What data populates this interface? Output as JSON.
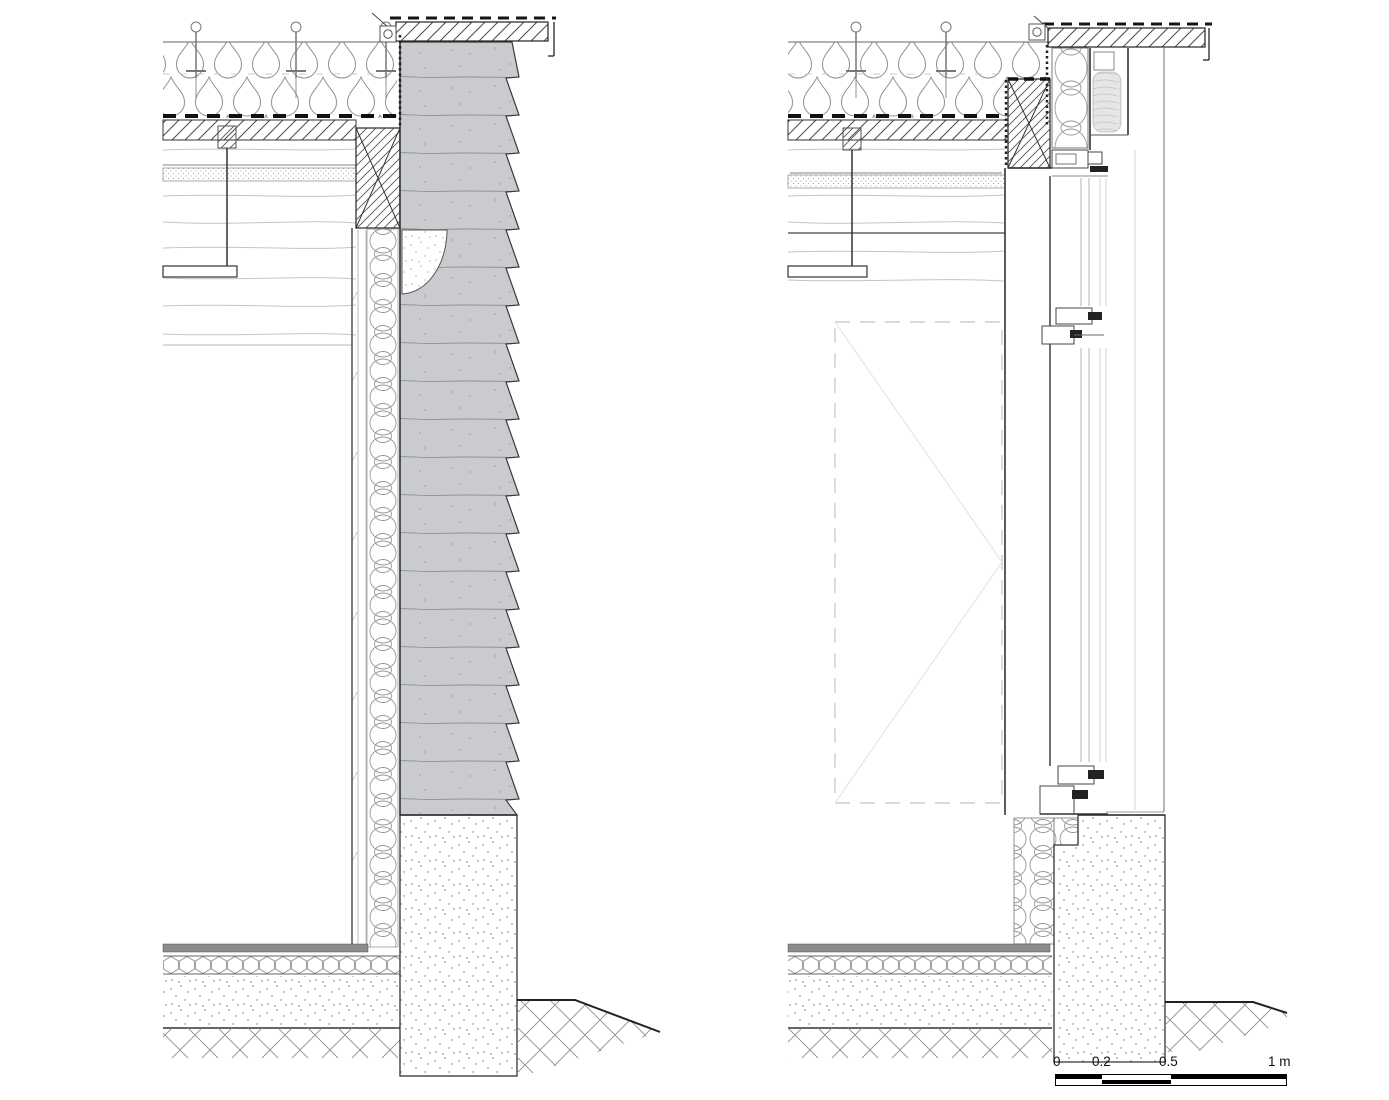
{
  "drawing": {
    "type": "architectural-section-details",
    "details": [
      {
        "id": "detail-left",
        "label": "Solid stone wall vertical section",
        "components": [
          "parapet-coping",
          "coping-membrane",
          "coping-anchor",
          "roof-insulation",
          "insulation-fasteners",
          "vapour-membrane",
          "roof-deck",
          "timber-beams",
          "service-board",
          "ceiling-hanger",
          "suspended-ceiling-board",
          "timber-blocking",
          "stone-masonry-wall",
          "corbel-infill",
          "interior-insulation",
          "interior-lining",
          "floor-finish",
          "floor-insulation-board",
          "floor-slab",
          "hardcore-ground",
          "concrete-plinth",
          "exterior-ground"
        ]
      },
      {
        "id": "detail-right",
        "label": "Glazed door / window vertical section",
        "components": [
          "parapet-coping",
          "coping-membrane",
          "coping-anchor",
          "roof-insulation",
          "insulation-fasteners",
          "vapour-membrane",
          "roof-deck",
          "timber-beams",
          "service-board",
          "ceiling-hanger",
          "suspended-ceiling-board",
          "timber-blocking",
          "head-insulation-box",
          "roller-blind-housing",
          "roller-blind-roll",
          "window-head-frame",
          "glazing",
          "transom-profile",
          "door-leaf-projection",
          "sill-frame",
          "sill-insulation",
          "floor-finish",
          "floor-insulation-board",
          "floor-slab",
          "hardcore-ground",
          "concrete-plinth",
          "exterior-ground"
        ]
      }
    ]
  },
  "scale_bar": {
    "labels": [
      "0",
      "0.2",
      "0.5",
      "1 m"
    ]
  },
  "colors": {
    "background": "#ffffff",
    "stone_fill": "#c9cbce",
    "blind_fill": "#e6e6e6",
    "floor_finish": "#8c8c8c",
    "ink": "#2f2f2f",
    "ink_light": "#9a9a9a"
  }
}
